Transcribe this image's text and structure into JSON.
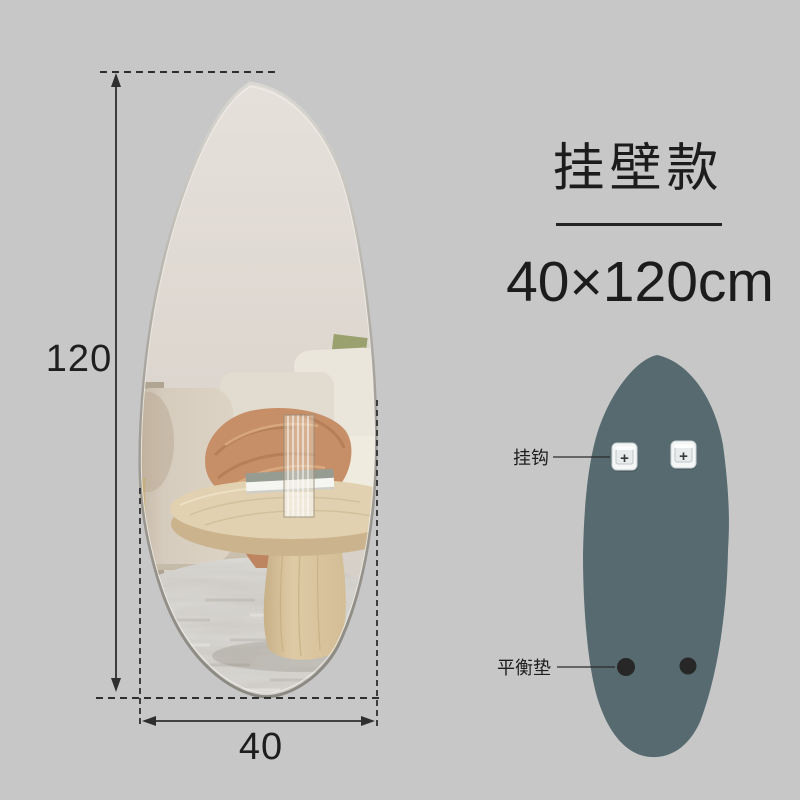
{
  "background_color": "#c7c7c7",
  "product": {
    "title": "挂壁款",
    "size": "40×120cm"
  },
  "dimensions": {
    "height_value": "120",
    "width_value": "40",
    "line_color": "#2f2f2f"
  },
  "mirror_front": {
    "shape": "irregular-pebble",
    "edge_color": "#9b978f",
    "reflection_wall_color": "#ded8d1",
    "reflection_sofa_color": "#eae5da",
    "reflection_blanket_color": "#c78f67",
    "reflection_table_color": "#e2d1b0",
    "reflection_rug_color": "#ccc9c3"
  },
  "back_view": {
    "body_color": "#566a70",
    "hook_label": "挂钩",
    "pad_label": "平衡垫",
    "hook_screw_glyph": "+",
    "hook_count": 2,
    "pad_count": 2,
    "hook_color": "#f5f7f7",
    "pad_color": "#272727"
  }
}
